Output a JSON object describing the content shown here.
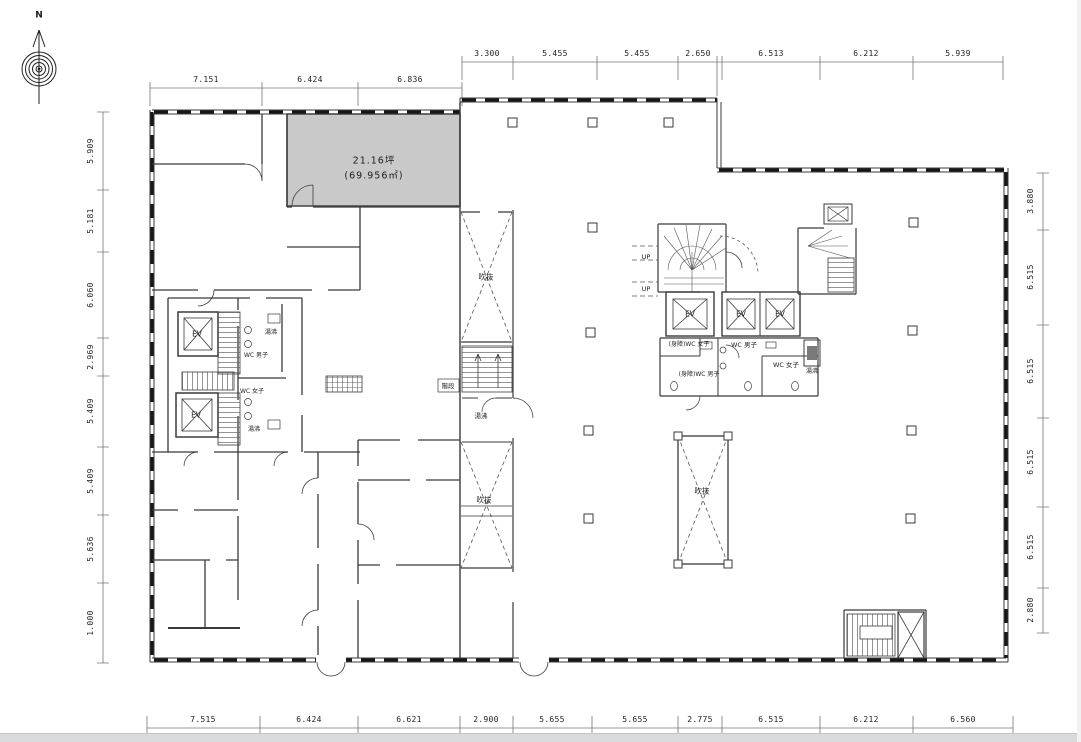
{
  "compass": {
    "north_label": "N"
  },
  "highlighted_room": {
    "area_tsubo": "21.16坪",
    "area_m2": "(69.956㎡)",
    "fill_color": "#c9c9c9"
  },
  "dimensions": {
    "top_left": [
      "7.151",
      "6.424",
      "6.836"
    ],
    "top_right": [
      "3.300",
      "5.455",
      "5.455",
      "2.650",
      "6.513",
      "6.212",
      "5.939"
    ],
    "left": [
      "5.909",
      "5.181",
      "6.060",
      "2.969",
      "5.409",
      "5.409",
      "5.636",
      "1.000"
    ],
    "right": [
      "3.880",
      "6.515",
      "6.515",
      "6.515",
      "6.515",
      "2.880"
    ],
    "bottom": [
      "7.515",
      "6.424",
      "6.621",
      "2.900",
      "5.655",
      "5.655",
      "2.775",
      "6.515",
      "6.212",
      "6.560"
    ]
  },
  "room_labels": {
    "elevator": "EV",
    "atrium": "吹抜",
    "stairs": "階段",
    "up": "UP",
    "wc_men": "WC 男子",
    "wc_women": "WC 女子",
    "wc_accessible_men": "(身障)WC 男子",
    "wc_accessible_women": "(身障)WC 女子",
    "hot_water": "湯沸"
  },
  "colors": {
    "line": "#3a3a3a",
    "highlight_fill": "#c9c9c9",
    "background": "#ffffff"
  }
}
